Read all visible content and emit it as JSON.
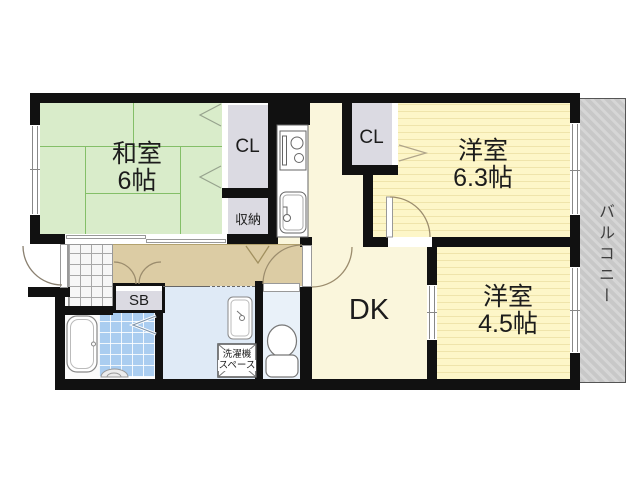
{
  "rooms": {
    "washitsu": {
      "name": "和室",
      "size": "6帖"
    },
    "bedroom1": {
      "name": "洋室",
      "size": "6.3帖"
    },
    "bedroom2": {
      "name": "洋室",
      "size": "4.5帖"
    },
    "dk": {
      "label": "DK"
    },
    "closet1": {
      "label": "CL"
    },
    "closet2": {
      "label": "CL"
    },
    "storage": {
      "label": "収納"
    },
    "shoe_box": {
      "label": "SB"
    },
    "laundry_space": {
      "line1": "洗濯機",
      "line2": "スペース"
    },
    "balcony": {
      "label": "バルコニー"
    }
  },
  "colors": {
    "wall_black": "#111111",
    "tatami_green": "#d9ecca",
    "room_yellow": "#fdf6c8",
    "hallway_tan": "#dccca4",
    "dk_cream": "#faf6dc",
    "closet_gray": "#dbdae2",
    "washroom_blue": "#dfeaf6",
    "bath_tile_blue": "#aacdf0",
    "balcony_gray": "#c8c8c8"
  }
}
